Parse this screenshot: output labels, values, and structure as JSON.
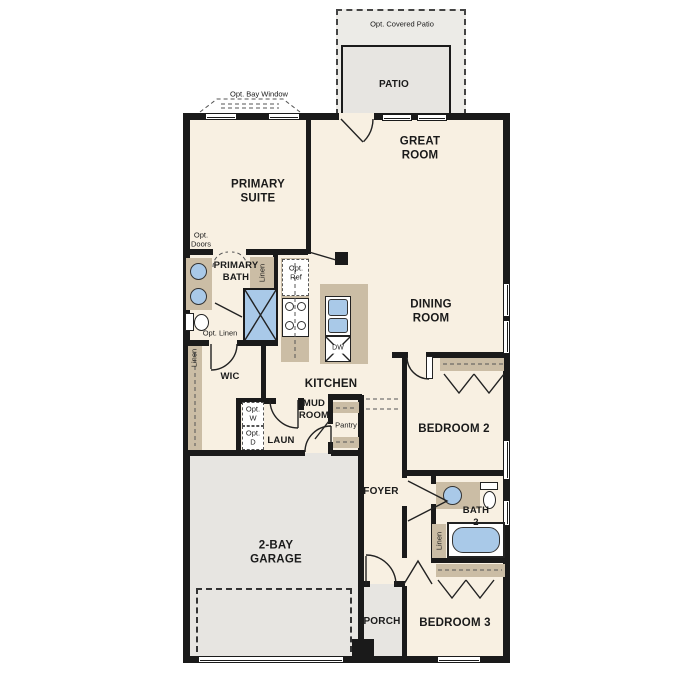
{
  "colors": {
    "wall": "#1a1a1a",
    "floor": "#f8f0e2",
    "exterior": "#e7e5e1",
    "exterior_light": "#ecebe7",
    "counter": "#cbbda5",
    "fixture": "#a9c9e8"
  },
  "labels": {
    "opt_covered_patio": "Opt. Covered Patio",
    "patio": "PATIO",
    "opt_bay_window": "Opt. Bay Window",
    "primary_suite": "PRIMARY\nSUITE",
    "great_room": "GREAT\nROOM",
    "dining_room": "DINING\nROOM",
    "primary_bath": "PRIMARY\nBATH",
    "opt_doors": "Opt.\nDoors",
    "opt_ref": "Opt.\nRef",
    "opt_linen": "Opt. Linen",
    "linen": "Linen",
    "wic": "WIC",
    "kitchen": "KITCHEN",
    "mud_room": "MUD\nROOM",
    "pantry": "Pantry",
    "laun": "LAUN",
    "opt_w": "Opt.\nW",
    "opt_d": "Opt.\nD",
    "dw": "DW",
    "foyer": "FOYER",
    "bedroom_2": "BEDROOM 2",
    "bath_2": "BATH\n2",
    "bedroom_3": "BEDROOM 3",
    "garage": "2-BAY\nGARAGE",
    "porch": "PORCH"
  }
}
